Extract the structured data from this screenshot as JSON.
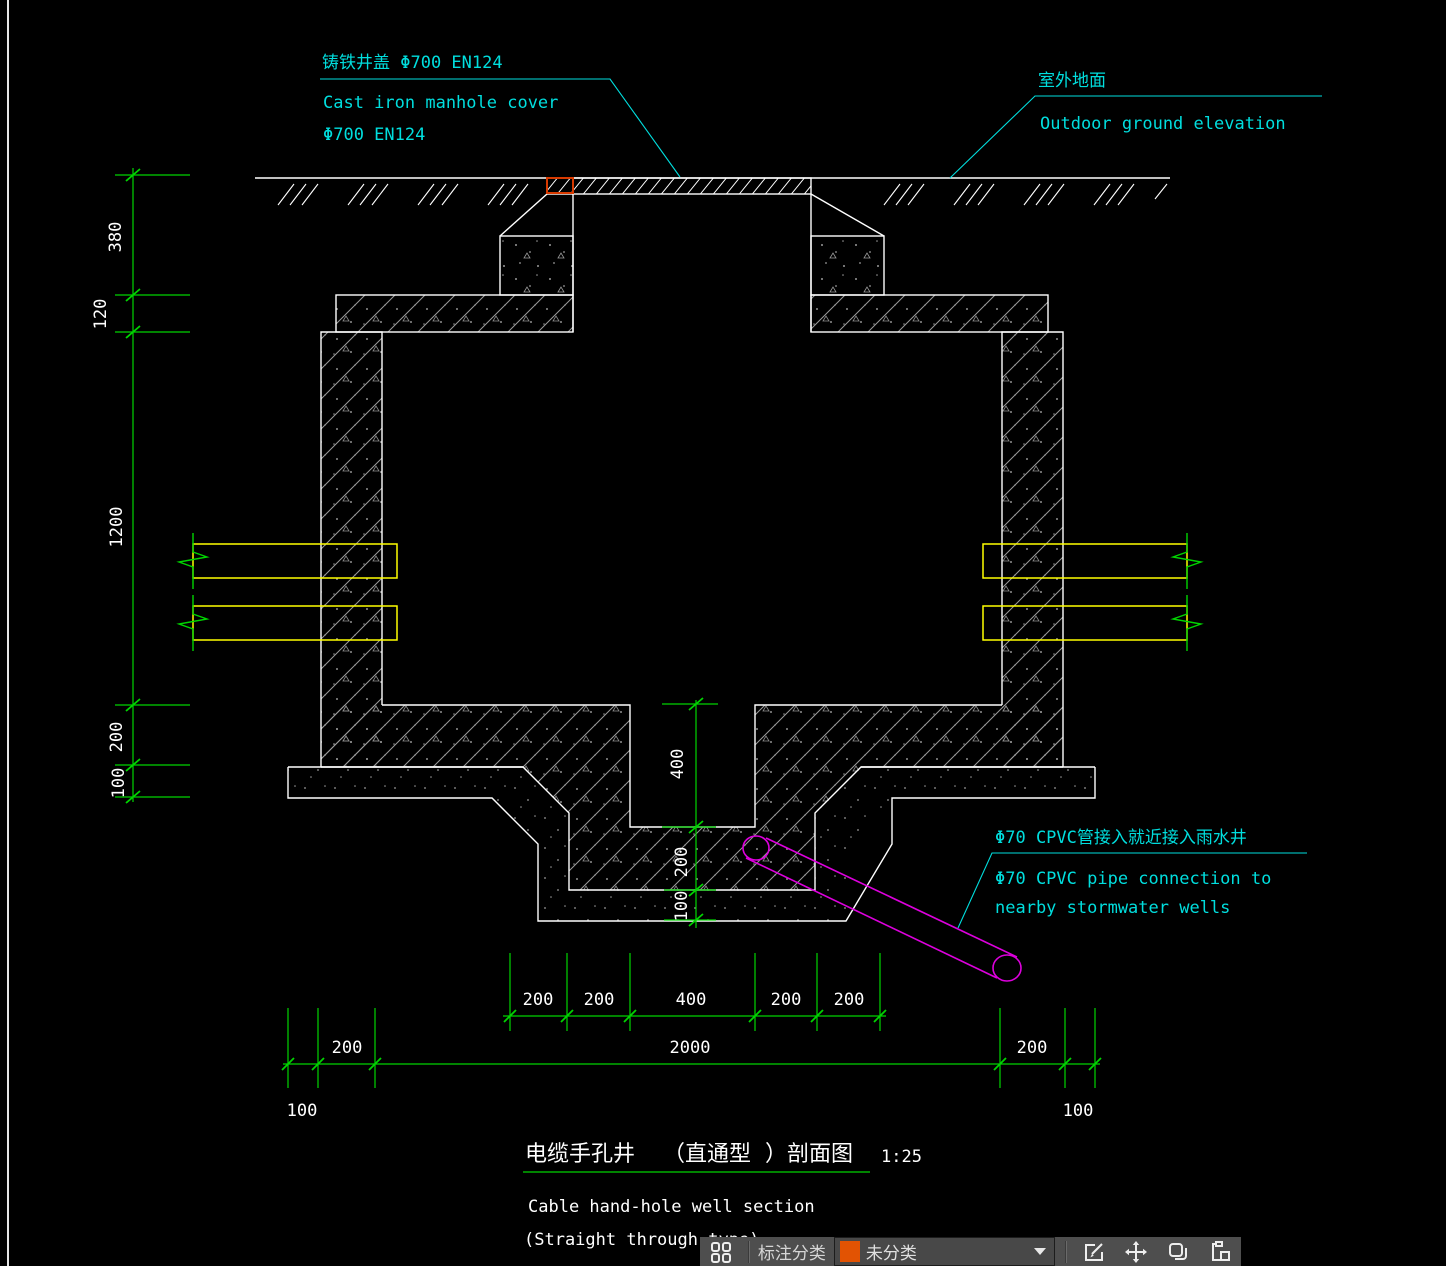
{
  "drawing": {
    "labels": {
      "cover_cn": "铸铁井盖 Φ700  EN124",
      "cover_en1": "Cast iron manhole cover",
      "cover_en2": "Φ700  EN124",
      "ground_cn": "室外地面",
      "ground_en": "Outdoor ground elevation",
      "cpvc_cn": "Φ70 CPVC管接入就近接入雨水井",
      "cpvc_en1": "Φ70 CPVC pipe connection to",
      "cpvc_en2": "nearby stormwater wells"
    },
    "dims": {
      "left": [
        "380",
        "120",
        "1200",
        "200",
        "100"
      ],
      "center": [
        "400",
        "200",
        "100"
      ],
      "row1": [
        "200",
        "200",
        "400",
        "200",
        "200"
      ],
      "row2": {
        "left": "200",
        "span": "2000",
        "right": "200"
      },
      "row3": {
        "left": "100",
        "right": "100"
      }
    },
    "title": {
      "cn_name": "电缆手孔井",
      "cn_type": "（直通型",
      "cn_suffix": "）剖面图",
      "scale": "1:25",
      "en_line1": "Cable hand-hole well section",
      "en_line2": "(Straight through type)"
    }
  },
  "toolbar": {
    "category_label": "标注分类",
    "dropdown": {
      "value": "未分类",
      "swatch_color": "#e25303"
    },
    "icons": [
      "grid-icon",
      "edit-icon",
      "move-icon",
      "copy-icon",
      "paste-icon"
    ]
  },
  "colors": {
    "background": "#000000",
    "line_white": "#ffffff",
    "dim_green": "#00d400",
    "label_cyan": "#00dede",
    "pipe_yellow": "#ffff00",
    "cpvc_magenta": "#dd00dd",
    "highlight_red": "#d83a00",
    "hatch_gray": "#9a9a9a",
    "toolbar_bg": "#4e4e4e"
  }
}
